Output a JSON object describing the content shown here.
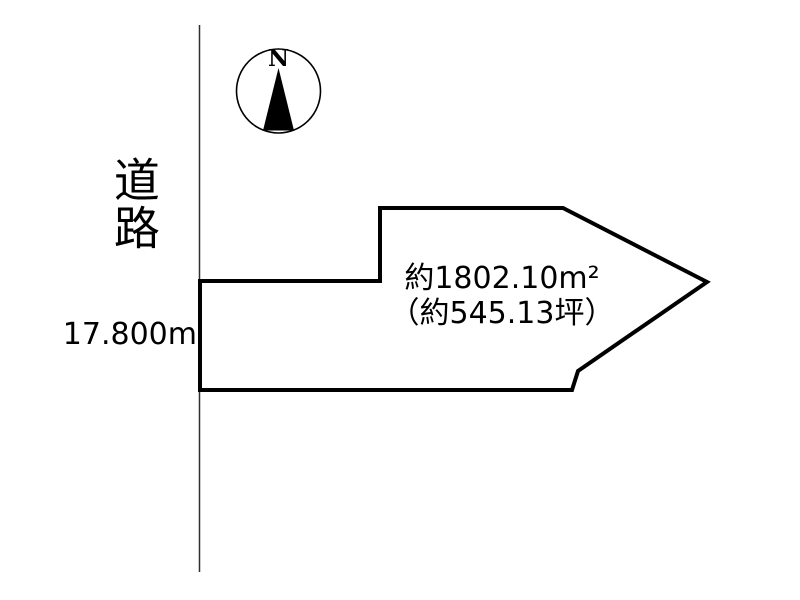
{
  "page": {
    "background": "#ffffff"
  },
  "compass": {
    "north_label": "N"
  },
  "road": {
    "label": "道路"
  },
  "parcel": {
    "frontage": "17.800m",
    "area_m2": "約1802.10m²",
    "area_tsubo": "（約545.13坪）"
  },
  "colors": {
    "outline": "#000000",
    "road_line": "#2f2f2f",
    "text": "#000000"
  }
}
